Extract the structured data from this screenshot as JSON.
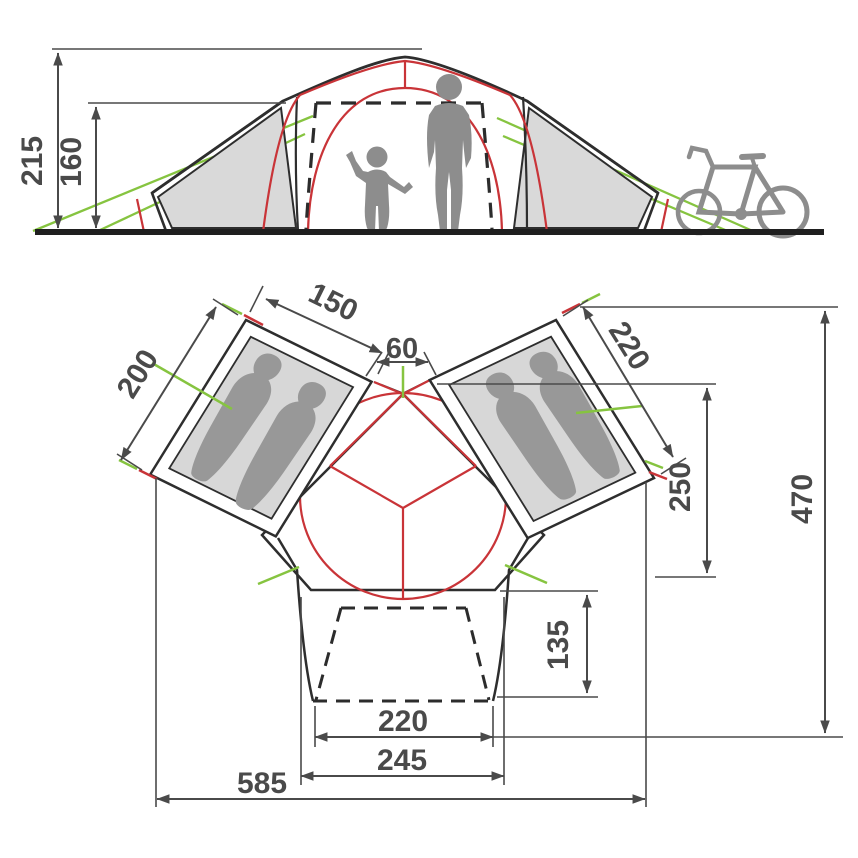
{
  "colors": {
    "outline_black": "#2e2e2e",
    "dimension_gray": "#4a4a4a",
    "pole_red": "#c93438",
    "guyline_green": "#86c440",
    "panel_gray": "#d9d9d9",
    "floor_gray": "#d7d7d7",
    "silhouette_gray": "#8d8d8d",
    "sleeping_bag_gray": "#989898"
  },
  "figures": {
    "side_view": [
      "adult-silhouette",
      "child-silhouette",
      "bicycle-silhouette"
    ],
    "floor_plan": [
      "sleeping-bag-silhouettes"
    ]
  },
  "side_view": {
    "dimensions": {
      "total_height": "215",
      "inner_height": "160"
    }
  },
  "floor_plan": {
    "dimensions": {
      "left_cabin_width": "150",
      "left_cabin_depth": "200",
      "center_gap": "60",
      "right_cabin_length": "220",
      "right_cabin_span": "250",
      "total_depth": "470",
      "porch_depth": "135",
      "porch_inner_width": "220",
      "porch_outer_width": "245",
      "total_width": "585"
    }
  }
}
